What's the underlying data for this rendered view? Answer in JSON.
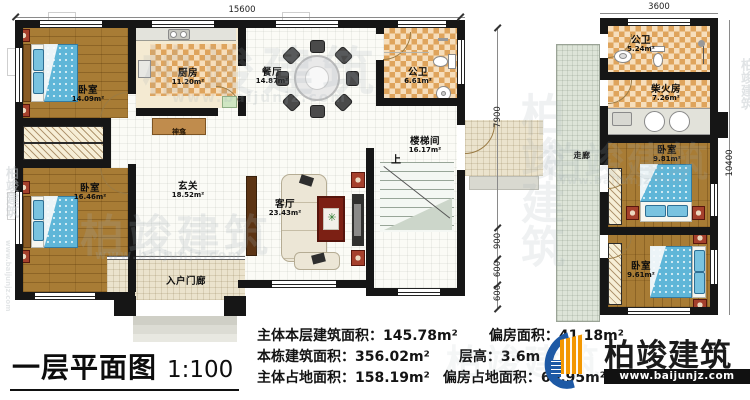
{
  "title": {
    "text": "一层平面图",
    "scale": "1:100"
  },
  "branding": {
    "name": "柏竣建筑",
    "url": "www.baijunjz.com"
  },
  "watermark": {
    "name": "柏竣建筑",
    "url": "www.baijunjz.com"
  },
  "dimensions": {
    "main_top": "15600",
    "main_right": [
      "7900",
      "900",
      "600",
      "600"
    ],
    "side_top": "3600",
    "side_right": "10400"
  },
  "main_plan": {
    "rooms": {
      "bedroom_top": {
        "name": "卧室",
        "area": "14.09m²"
      },
      "bedroom_bottom": {
        "name": "卧室",
        "area": "16.46m²"
      },
      "kitchen": {
        "name": "厨房",
        "area": "11.20m²"
      },
      "dining": {
        "name": "餐厅",
        "area": "14.87m²"
      },
      "bathroom": {
        "name": "公卫",
        "area": "6.61m²"
      },
      "stairwell": {
        "name": "楼梯间",
        "area": "16.17m²"
      },
      "hall": {
        "name": "玄关",
        "area": "18.52m²"
      },
      "living": {
        "name": "客厅",
        "area": "23.43m²"
      },
      "porch": {
        "name": "入户门廊"
      },
      "shrine": {
        "name": "神龛"
      },
      "stairs_up": "上"
    }
  },
  "side_plan": {
    "rooms": {
      "corridor": {
        "name": "走廊"
      },
      "bathroom": {
        "name": "公卫",
        "area": "5.24m²"
      },
      "firewood": {
        "name": "柴火房",
        "area": "7.26m²"
      },
      "bedroom_mid": {
        "name": "卧室",
        "area": "9.81m²"
      },
      "bedroom_bottom": {
        "name": "卧室",
        "area": "9.61m²"
      }
    }
  },
  "stats": {
    "rows": [
      {
        "items": [
          {
            "label": "主体本层建筑面积：",
            "value": "145.78m²"
          },
          {
            "label": "偏房面积：",
            "value": "41.18m²"
          }
        ]
      },
      {
        "items": [
          {
            "label": "本栋建筑面积：",
            "value": "356.02m²"
          },
          {
            "label": "层高：",
            "value": "3.6m"
          }
        ]
      },
      {
        "items": [
          {
            "label": "主体占地面积：",
            "value": "158.19m²"
          },
          {
            "label": "偏房占地面积：",
            "value": "60.95m²"
          }
        ]
      }
    ]
  },
  "colors": {
    "wall": "#161616",
    "wood_floor": "#a87c35",
    "bed_blue": "#5fb6d8",
    "tile_orange": "#dfa45c",
    "accent_red": "#a5402c",
    "logo_blue": "#1d59a5",
    "logo_orange": "#f39700"
  }
}
